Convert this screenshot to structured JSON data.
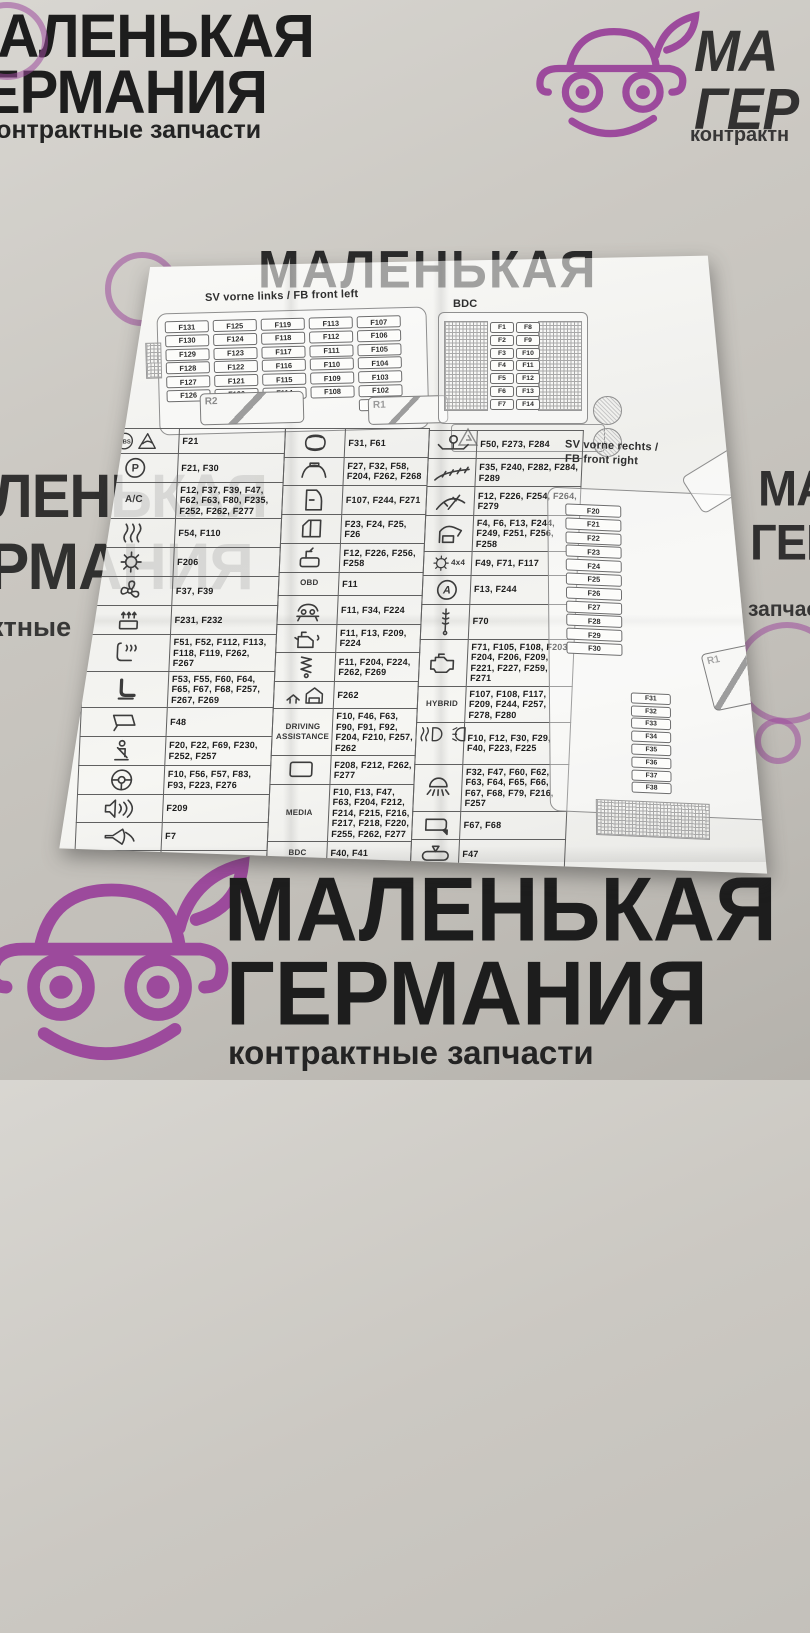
{
  "background": {
    "brand_line1": "МАЛЕНЬКАЯ",
    "brand_line2": "ГЕРМАНИЯ",
    "brand_sub": "контрактные запчасти",
    "top_right_frag1": "МА",
    "top_right_frag2": "ГЕР",
    "top_right_frag3": "контрактн",
    "left_mid_frag1": "ЛЕНЬКАЯ",
    "left_mid_frag2": "РМАНИЯ",
    "left_mid_frag3": "ктные",
    "right_mid_frag1": "МА",
    "right_mid_frag2": "ГЕРМ",
    "right_mid_frag3": "запчасти",
    "colors": {
      "surface": "#c9c6c0",
      "brand_text": "#1d1d1d",
      "logo_purple": "#9c4a9c",
      "paper": "#f4f4f1"
    }
  },
  "paper": {
    "left_box": {
      "title": "SV vorne links / FB front left",
      "fuse_columns": [
        [
          "F131",
          "F130",
          "F129",
          "F128",
          "F127",
          "F126"
        ],
        [
          "F125",
          "F124",
          "F123",
          "F122",
          "F121",
          "F120"
        ],
        [
          "F119",
          "F118",
          "F117",
          "F116",
          "F115",
          "F114"
        ],
        [
          "F113",
          "F112",
          "F111",
          "F110",
          "F109",
          "F108"
        ],
        [
          "F107",
          "F106",
          "F105",
          "F104",
          "F103",
          "F102",
          "F101"
        ]
      ],
      "relay1": "R2",
      "relay2": "R1"
    },
    "bdc_box": {
      "title": "BDC",
      "fuse_rows": [
        [
          "F1",
          "F8"
        ],
        [
          "F2",
          "F9"
        ],
        [
          "F3",
          "F10"
        ],
        [
          "F4",
          "F11"
        ],
        [
          "F5",
          "F12"
        ],
        [
          "F6",
          "F13"
        ],
        [
          "F7",
          "F14"
        ]
      ]
    },
    "right_box": {
      "title_line1": "SV vorne rechts /",
      "title_line2": "FB front right",
      "col_a": [
        "F20",
        "F21",
        "F22",
        "F23",
        "F24",
        "F25",
        "F26",
        "F27",
        "F28",
        "F29",
        "F30"
      ],
      "col_a2": [
        "F46",
        "F47",
        "F48",
        "F49",
        "F50",
        "F51",
        "F52",
        "F53",
        "F54",
        "F55",
        "F56",
        "F57",
        "F58",
        "F59"
      ],
      "col_b": [
        "F31",
        "F32",
        "F33",
        "F34",
        "F35",
        "F36",
        "F37",
        "F38"
      ],
      "col_b2": [
        "F60",
        "F61",
        "F62",
        "F63",
        "F64",
        "F65",
        "F66",
        "F67",
        "F68",
        "F69",
        "F70",
        "F71"
      ],
      "col_c": [
        "F77",
        "F78",
        "F79",
        "F80",
        "F81",
        "F82",
        "F83"
      ],
      "col_c2": [
        "F84",
        "F85",
        "F86"
      ],
      "col_d": [
        "F87",
        "F88",
        "F89",
        "F90",
        "F91",
        "F92",
        "F93"
      ],
      "col_d2": [
        "F94",
        "F95"
      ],
      "big_fuses": [
        "F39",
        "F40",
        "F41"
      ],
      "relay": "R1"
    },
    "table": {
      "left_rows": [
        {
          "icon": "abs-traction-icon",
          "fuses": "F21"
        },
        {
          "icon": "parking-brake-icon",
          "fuses": "F21, F30"
        },
        {
          "label": "A/C",
          "fuses": "F12, F37, F39, F47, F62, F63, F80, F235, F252, F262, F277"
        },
        {
          "icon": "heated-windshield-icon",
          "fuses": "F54, F110"
        },
        {
          "icon": "auxiliary-heater-icon",
          "fuses": "F206"
        },
        {
          "icon": "fan-icon",
          "fuses": "F37, F39"
        },
        {
          "icon": "air-vent-icon",
          "fuses": "F231, F232"
        },
        {
          "icon": "heated-seat-icon",
          "fuses": "F51, F52, F112, F113, F118, F119, F262, F267"
        },
        {
          "icon": "power-seat-icon",
          "fuses": "F53, F55, F60, F64, F65, F67, F68, F257, F267, F269"
        },
        {
          "icon": "rearview-mirror-icon",
          "fuses": "F48"
        },
        {
          "icon": "seatbelt-icon",
          "fuses": "F20, F22, F69, F230, F252, F257"
        },
        {
          "icon": "steering-wheel-icon",
          "fuses": "F10, F56, F57, F83, F93, F223, F276"
        },
        {
          "icon": "speaker-icon",
          "fuses": "F209"
        },
        {
          "icon": "horn-icon",
          "fuses": "F7"
        },
        {
          "icon": "remote-key-icon",
          "fuses": "F32, F244"
        }
      ],
      "middle_rows": [
        {
          "icon": "car-top-icon",
          "fuses": "F31, F61"
        },
        {
          "icon": "sunroof-icon",
          "fuses": "F27, F32, F58, F204, F262, F268"
        },
        {
          "icon": "door-icon",
          "fuses": "F107, F244, F271"
        },
        {
          "icon": "window-icon",
          "fuses": "F23, F24, F25, F26"
        },
        {
          "icon": "window-switch-icon",
          "fuses": "F12, F226, F256, F258"
        },
        {
          "label": "OBD",
          "fuses": "F11"
        },
        {
          "icon": "vehicle-lift-icon",
          "fuses": "F11, F34, F224"
        },
        {
          "icon": "engine-oil-icon",
          "fuses": "F11, F13, F209, F224"
        },
        {
          "icon": "suspension-icon",
          "fuses": "F11, F204, F224, F262, F269"
        },
        {
          "icon": "garage-icon",
          "fuses": "F262"
        },
        {
          "label": "DRIVING ASSISTANCE",
          "fuses": "F10, F46, F63, F90, F91, F92, F204, F210, F257, F262"
        },
        {
          "icon": "display-icon",
          "fuses": "F208, F212, F262, F277"
        },
        {
          "label": "MEDIA",
          "fuses": "F10, F13, F47, F63, F204, F212, F214, F215, F216, F217, F218, F220, F255, F262, F277"
        },
        {
          "label": "BDC",
          "fuses": "F40, F41"
        },
        {
          "icon": "gear-icon",
          "fuses": "F30"
        }
      ],
      "right_rows": [
        {
          "icon": "trailer-hitch-icon",
          "fuses": "F50, F273, F284"
        },
        {
          "icon": "washer-nozzle-icon",
          "fuses": "F35, F240, F282, F284, F289"
        },
        {
          "icon": "wiper-icon",
          "fuses": "F12, F226, F254, F264, F279"
        },
        {
          "icon": "tailgate-icon",
          "fuses": "F4, F6, F13, F244, F249, F251, F256, F258"
        },
        {
          "icon": "four-wheel-drive-icon",
          "label": "4x4",
          "fuses": "F49, F71, F117"
        },
        {
          "icon": "start-stop-icon",
          "fuses": "F13, F244"
        },
        {
          "icon": "exhaust-sensor-icon",
          "fuses": "F70"
        },
        {
          "icon": "engine-icon",
          "fuses": "F71, F105, F108, F203, F204, F206, F209, F221, F227, F259, F271"
        },
        {
          "label": "HYBRID",
          "fuses": "F107, F108, F117, F209, F244, F257, F278, F280"
        },
        {
          "icon": "headlight-icon",
          "fuses": "F10, F12, F30, F29, F40, F223, F225"
        },
        {
          "icon": "interior-light-icon",
          "fuses": "F32, F47, F60, F62, F63, F64, F65, F66, F67, F68, F79, F216, F257"
        },
        {
          "icon": "exterior-mirror-icon",
          "fuses": "F67, F68"
        },
        {
          "icon": "interior-mirror-icon",
          "fuses": "F47"
        }
      ]
    }
  }
}
